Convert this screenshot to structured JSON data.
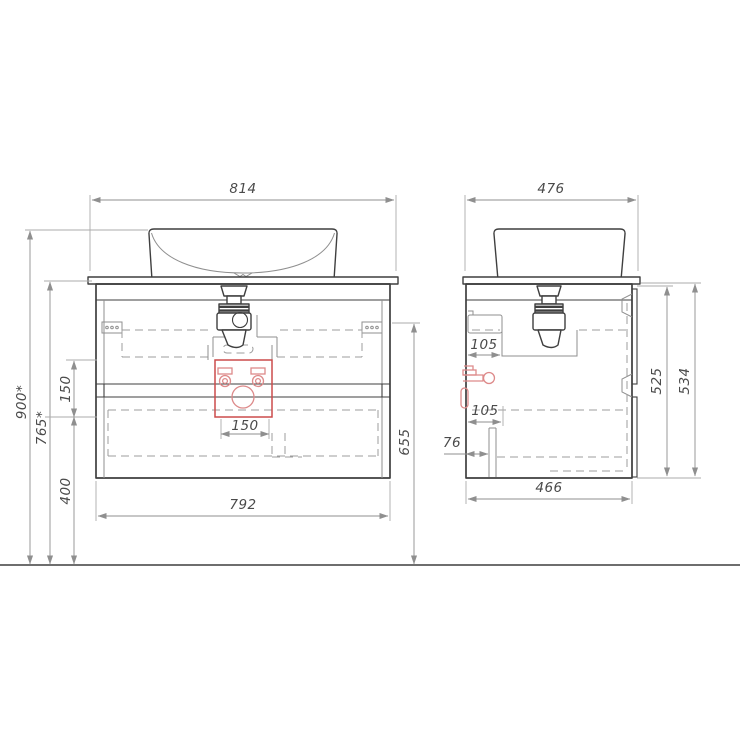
{
  "drawing_title": "Bathroom vanity with vessel basin - dimensional drawing",
  "colors": {
    "outline": "#3f3f3f",
    "internal_lines": "#9c9c9c",
    "dimension_lines": "#8f8f8f",
    "dimension_text": "#4a4a4a",
    "highlight_zone_red": "#cc4c4c",
    "fittings_red": "#dd8a8a",
    "background": "#ffffff"
  },
  "views": {
    "front": {
      "dims": {
        "counter_width": "814",
        "cabinet_width": "792",
        "overall_height": "900*",
        "counter_height": "765*",
        "supply_spacing_vertical": "150",
        "drain_outlet_height": "400",
        "rail_height": "655",
        "connection_zone_width": "150"
      }
    },
    "side": {
      "dims": {
        "counter_depth": "476",
        "cabinet_depth": "466",
        "upper_connection_offset": "105",
        "lower_connection_offset": "105",
        "waste_pipe_offset": "76",
        "cabinet_height": "525",
        "overall_cabinet_counter_height": "534"
      }
    }
  }
}
